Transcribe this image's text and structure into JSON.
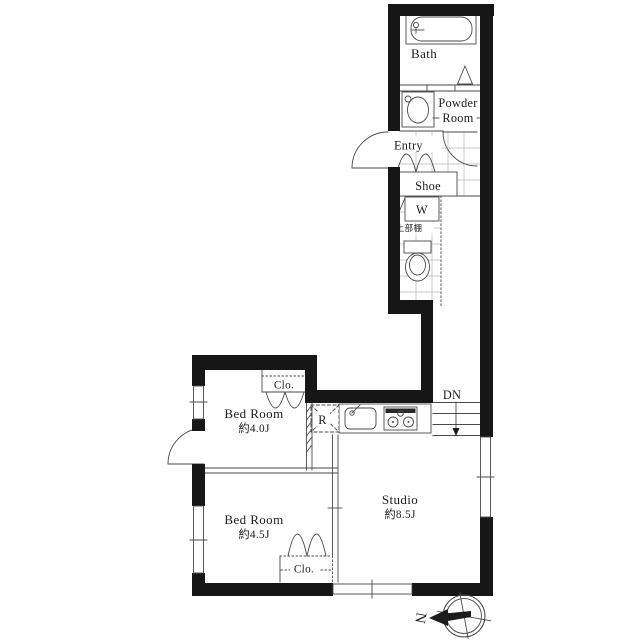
{
  "plan": {
    "bath": {
      "label": "Bath"
    },
    "powder_room": {
      "line1": "Powder",
      "line2": "Room"
    },
    "entry": {
      "label": "Entry"
    },
    "shoe": {
      "label": "Shoe"
    },
    "washer": {
      "label": "W",
      "shelf_note": "上部棚"
    },
    "stairs": {
      "label": "DN"
    },
    "kitchen": {
      "refrigerator_label": "R"
    },
    "bedroom_a": {
      "label": "Bed Room",
      "area": "約4.0J"
    },
    "bedroom_b": {
      "label": "Bed Room",
      "area": "約4.5J"
    },
    "studio": {
      "label": "Studio",
      "area": "約8.5J"
    },
    "closet_a": {
      "label": "Clo."
    },
    "closet_b": {
      "label": "Clo."
    },
    "compass": {
      "label": "N"
    }
  },
  "colors": {
    "wall": "#161616",
    "line": "#4a4a4a",
    "grid": "#b8b8b8",
    "text": "#1c1c1c"
  }
}
